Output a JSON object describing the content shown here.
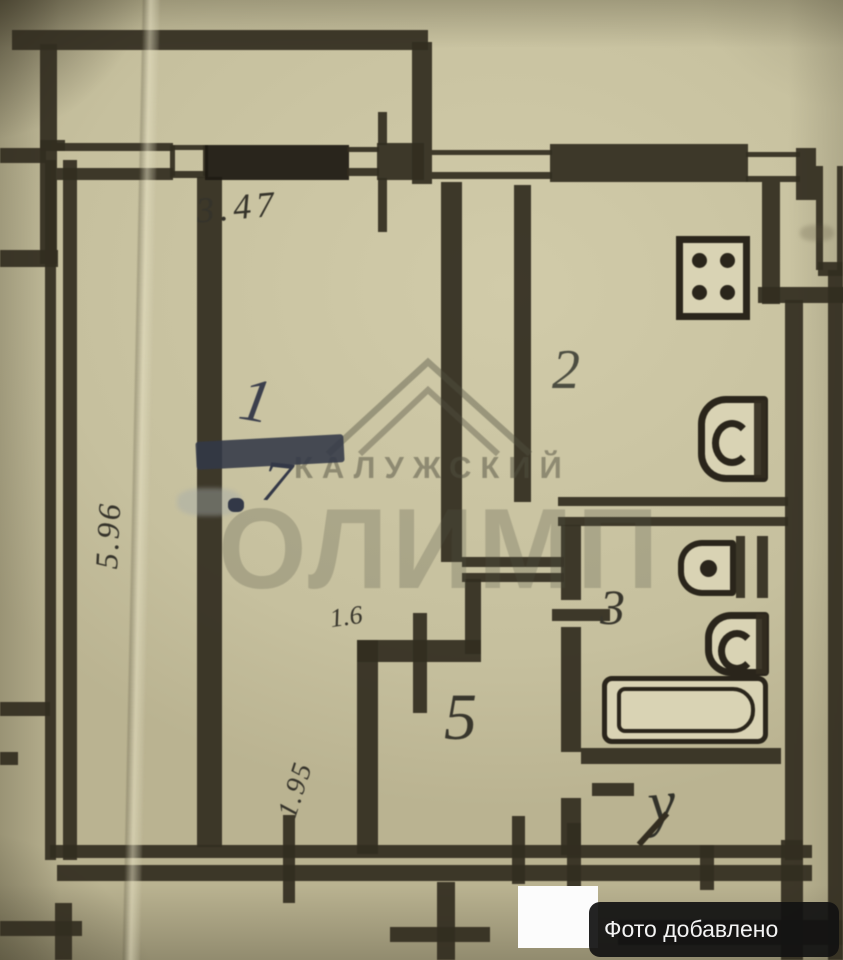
{
  "watermark": {
    "line1": "КАЛУЖСКИЙ",
    "line2": "ОЛИМП"
  },
  "badge": {
    "label": "Фото добавлено Авито"
  },
  "plan": {
    "dimensions": {
      "top_width": "3.47",
      "left_height": "5.96",
      "niche_width": "1.6",
      "hall_height": "1.95"
    },
    "rooms": {
      "living": {
        "number": "1",
        "area_digit": "7"
      },
      "kitchen": {
        "number": "2"
      },
      "bath": {
        "number": "3"
      },
      "wc": {
        "number": "у"
      },
      "hall": {
        "number": "5"
      }
    }
  }
}
